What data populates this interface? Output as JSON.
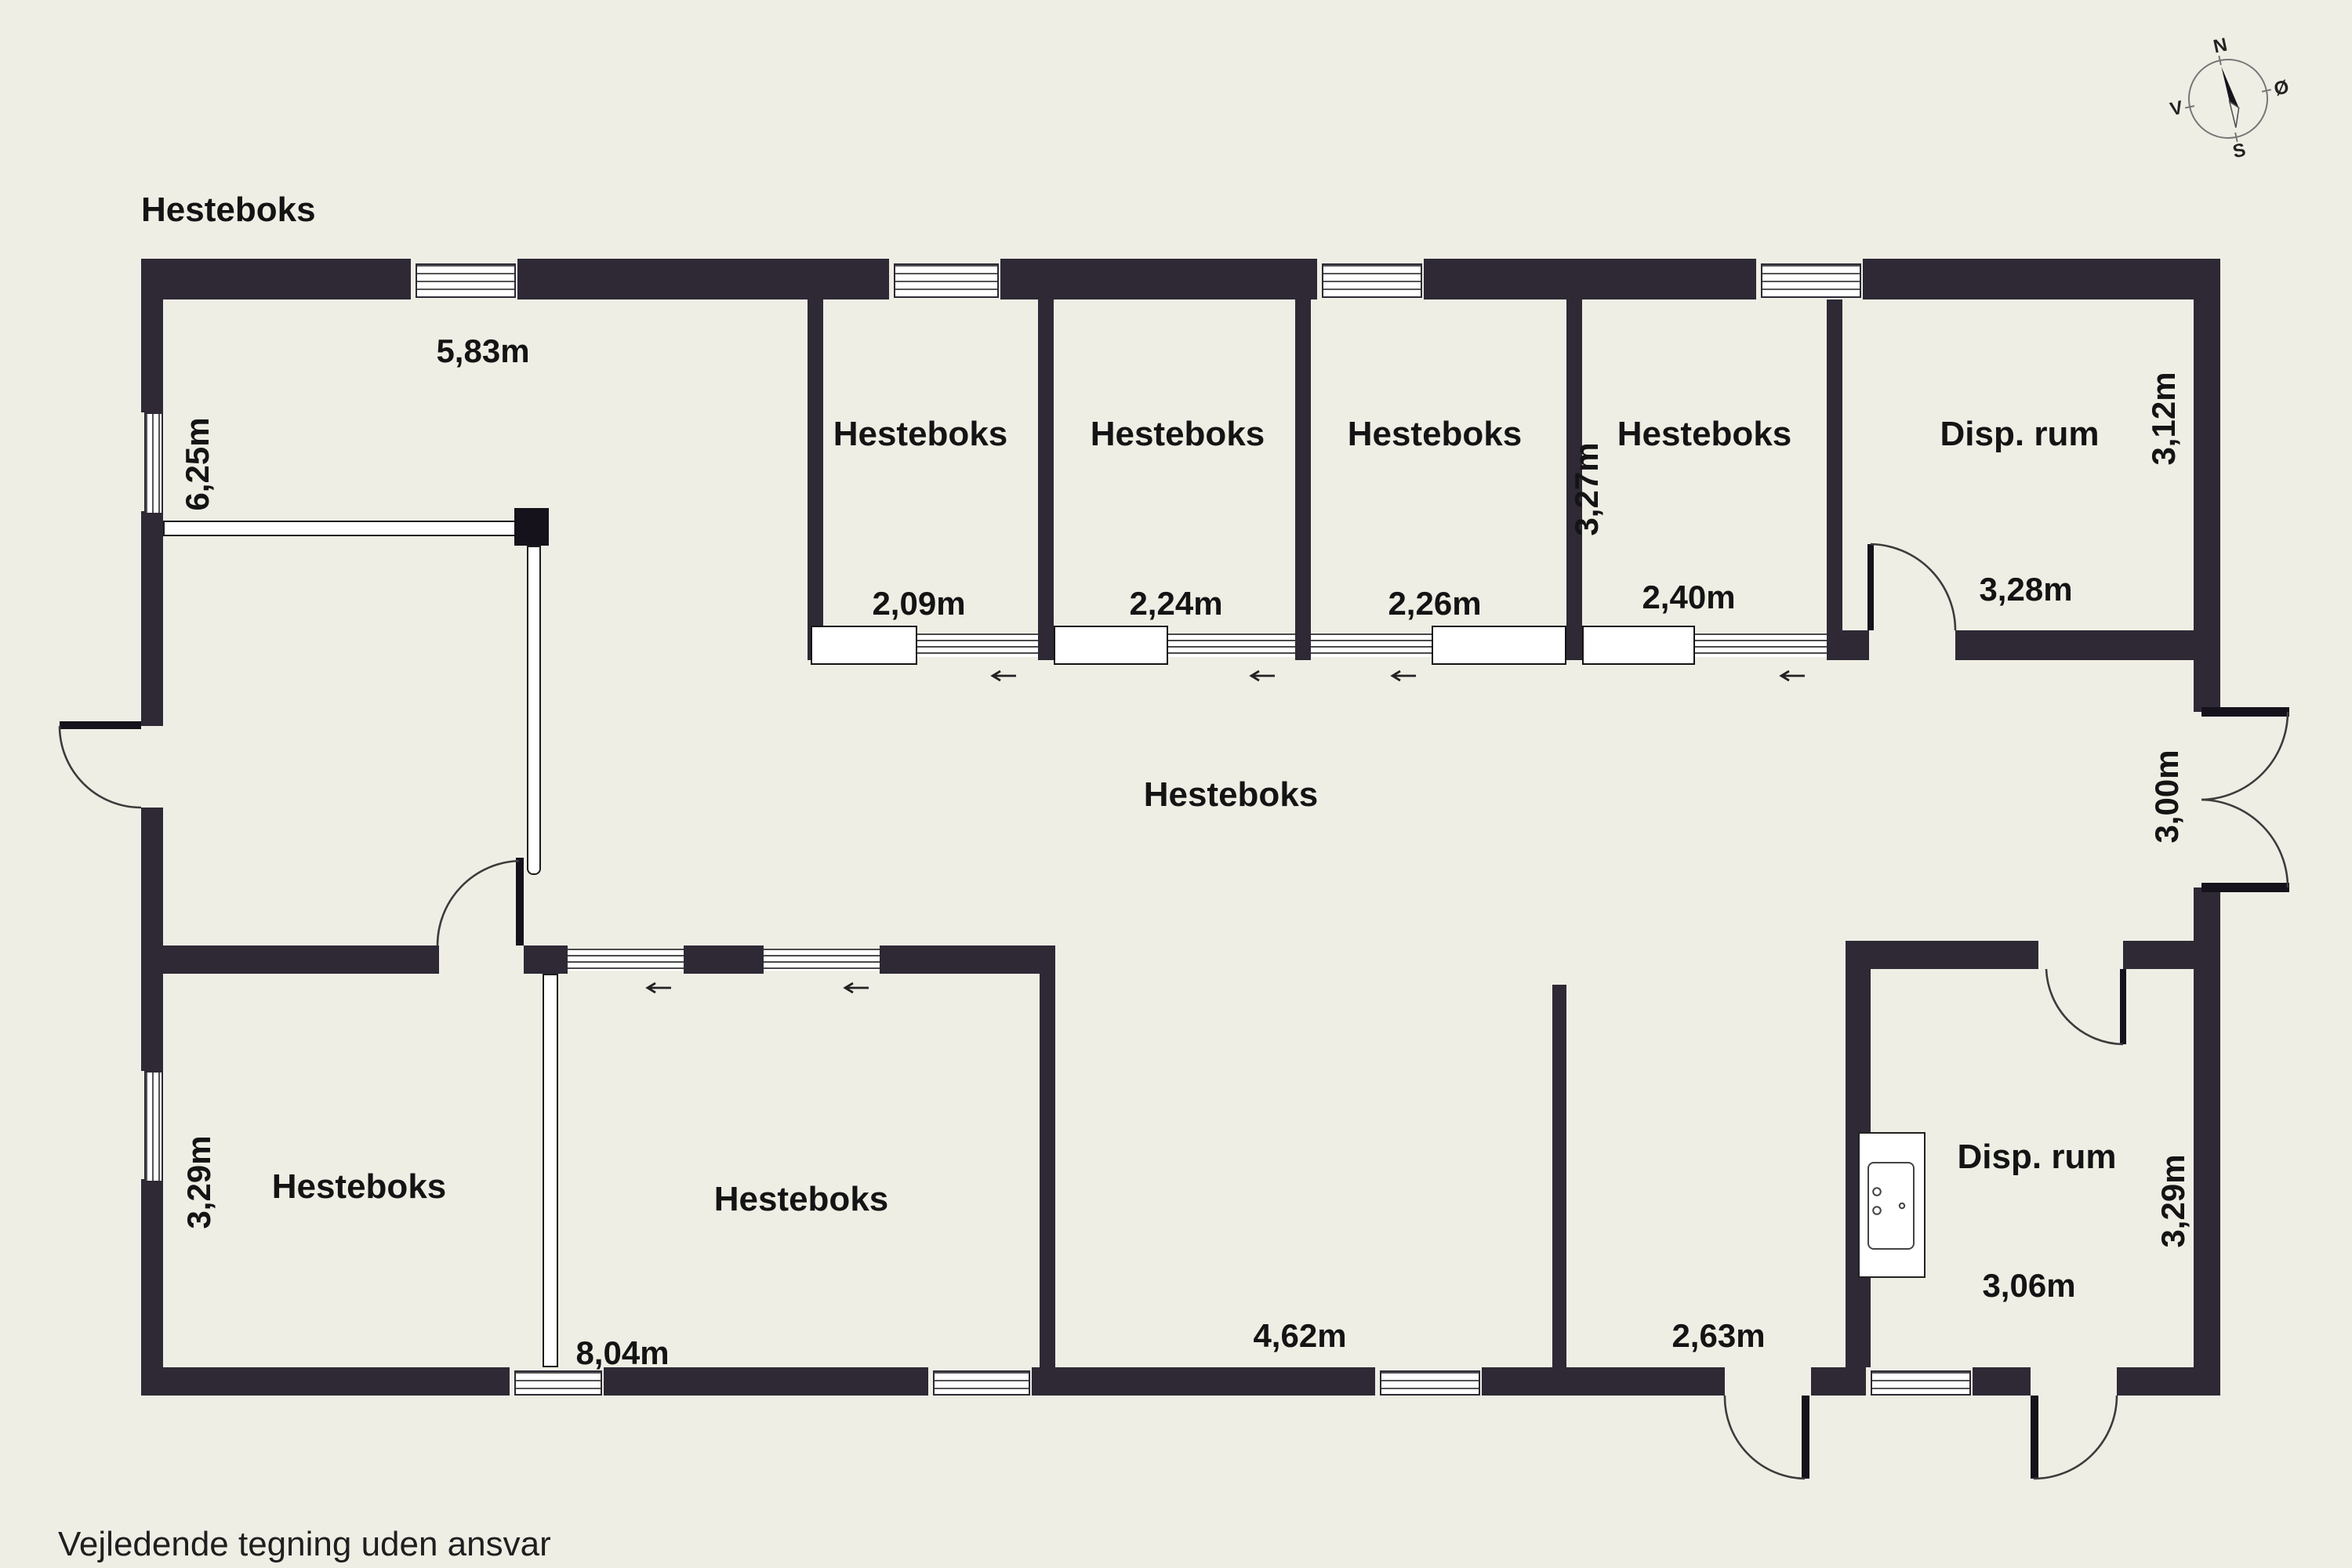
{
  "drawing": {
    "footer_note": "Vejledende tegning uden ansvar",
    "background_color": "#efeee5",
    "wall_color": "#2e2935",
    "text_color": "#141414"
  },
  "compass": {
    "north": "N",
    "east": "Ø",
    "south": "S",
    "west": "V"
  },
  "rooms": {
    "top_left": {
      "name": "Hesteboks",
      "width": "5,83m",
      "height": "6,25m"
    },
    "stall_1": {
      "name": "Hesteboks",
      "width": "2,09m"
    },
    "stall_2": {
      "name": "Hesteboks",
      "width": "2,24m"
    },
    "stall_3": {
      "name": "Hesteboks",
      "width": "2,26m"
    },
    "stall_4": {
      "name": "Hesteboks",
      "width": "2,40m",
      "depth": "3,27m"
    },
    "disp_top": {
      "name": "Disp. rum",
      "width": "3,28m",
      "depth": "3,12m"
    },
    "central": {
      "name": "Hesteboks",
      "door_width": "3,00m"
    },
    "bottom_left": {
      "name": "Hesteboks",
      "depth": "3,29m"
    },
    "bottom_middle": {
      "name": "Hesteboks",
      "width": "8,04m"
    },
    "central_south": {
      "width_mid": "4,62m",
      "width_right": "2,63m"
    },
    "disp_bottom": {
      "name": "Disp. rum",
      "width": "3,06m",
      "depth": "3,29m"
    }
  }
}
